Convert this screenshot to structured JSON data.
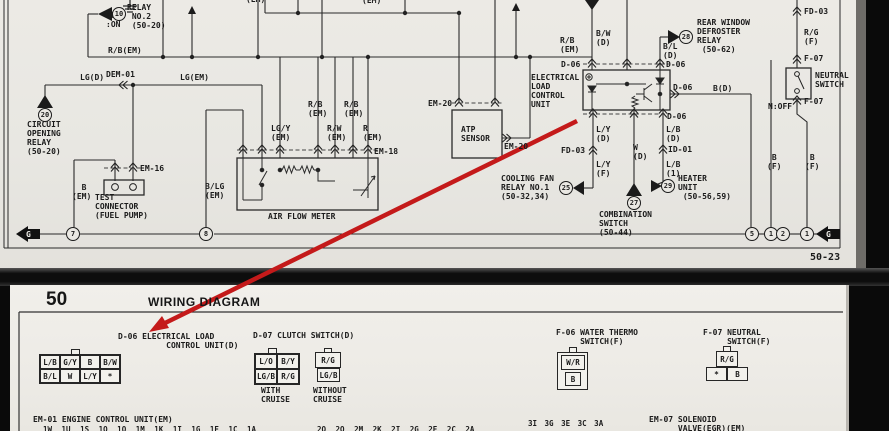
{
  "top": {
    "page_number": "50-23",
    "turn_indicator": "TURN\n:ON",
    "relay_no2": {
      "num": "10",
      "label": "RELAY\n NO.2\n (50-20)"
    },
    "circuit_opening_relay": {
      "num": "20",
      "label": "CIRCUIT\nOPENING\nRELAY\n(50-20)"
    },
    "cooling_fan_relay": {
      "num": "25",
      "label": "COOLING FAN\nRELAY NO.1\n(50-32,34)"
    },
    "combination_switch": {
      "num": "27",
      "label": "COMBINATION\nSWITCH\n(50-44)"
    },
    "rear_defroster_relay": {
      "num": "28",
      "label": "REAR WINDOW\nDEFROSTER\nRELAY\n (50-62)"
    },
    "heater_unit": {
      "num": "29",
      "label": "HEATER\nUNIT\n (50-56,59)"
    },
    "elcu_label": "ELECTRICAL\nLOAD\nCONTROL\nUNIT",
    "atp_sensor": "ATP\nSENSOR",
    "air_flow_meter": "AIR FLOW METER",
    "test_connector": "TEST\nCONNECTOR\n(FUEL PUMP)",
    "neutral_switch": "NEUTRAL\nSWITCH",
    "n_off": "N:OFF",
    "wires": {
      "rb_em_bus": "R/B(EM)",
      "lg_d": "LG(D)",
      "dem01": "DEM-01",
      "lg_em": "LG(EM)",
      "em16": "EM-16",
      "b_em": "  B\n(EM)",
      "blg_em": "B/LG\n(EM)",
      "em18": "EM-18",
      "em_partial_1": "(EM)",
      "em_partial_2": "(EM)",
      "rb_em_1": "R/B\n(EM)",
      "rb_em_2": "R/B\n(EM)",
      "lgy_em": "LG/Y\n(EM)",
      "rw_em": "R/W\n(EM)",
      "r_em": "R\n(EM)",
      "em20_a": "EM-20",
      "em20_b": "EM-20",
      "rb_em_right": "R/B\n(EM)",
      "bw_d": "B/W\n(D)",
      "bl_d": "B/L\n(D)",
      "d06_tl": "D-06",
      "d06_tr": "D-06",
      "d06_right": "D-06",
      "d06_bottom": "D-06",
      "b_d": "B(D)",
      "ly_d": "L/Y\n(D)",
      "w_d": "W\n(D)",
      "lb_d": "L/B\n(D)",
      "fd03_mid": "FD-03",
      "ly_f": "L/Y\n(F)",
      "id01": "ID-01",
      "lb_1": "L/B\n(1)",
      "fd03_top": "FD-03",
      "rg_f": "R/G\n(F)",
      "f07_a": "F-07",
      "f07_b": "F-07",
      "bf_1": " B\n(F)",
      "bf_2": " B\n(F)"
    },
    "ground_circles": [
      "7",
      "8",
      "5",
      "1",
      "2",
      "1"
    ],
    "g_arrow_left": "G",
    "g_arrow_right": "G"
  },
  "bottom": {
    "section_number": "50",
    "section_title": "WIRING DIAGRAM",
    "d06": {
      "title": "D-06 ELECTRICAL LOAD\n          CONTROL UNIT(D)",
      "row1": [
        "L/B",
        "G/Y",
        "B",
        "B/W"
      ],
      "row2": [
        "B/L",
        "W",
        "L/Y",
        "*"
      ]
    },
    "d07": {
      "title": "D-07 CLUTCH SWITCH(D)",
      "with_cruise": {
        "row1": [
          "L/O",
          "B/Y"
        ],
        "row2": [
          "LG/B",
          "R/G"
        ],
        "caption": "WITH\nCRUISE"
      },
      "without_cruise": {
        "top": "R/G",
        "bottom": "LG/B",
        "caption": "WITHOUT\nCRUISE"
      }
    },
    "f06": {
      "title": "F-06 WATER THERMO\n     SWITCH(F)",
      "top": "W/R",
      "bottom": "B"
    },
    "f07": {
      "title": "F-07 NEUTRAL\n     SWITCH(F)",
      "top": "R/G",
      "bottom_left": "*",
      "bottom_right": "B"
    },
    "em01": {
      "title": "EM-01 ENGINE CONTROL UNIT(EM)",
      "pins1": "1W 1U 1S 1Q 1O 1M 1K 1I 1G 1E 1C 1A",
      "pins2": "2Q 2O 2M 2K 2I 2G 2E 2C 2A",
      "pins3": "3I 3G 3E 3C 3A"
    },
    "em07": {
      "title": "EM-07 SOLENOID\n      VALVE(EGR)(EM)"
    }
  },
  "annotation": {
    "arrow_color": "#c41a1a"
  }
}
